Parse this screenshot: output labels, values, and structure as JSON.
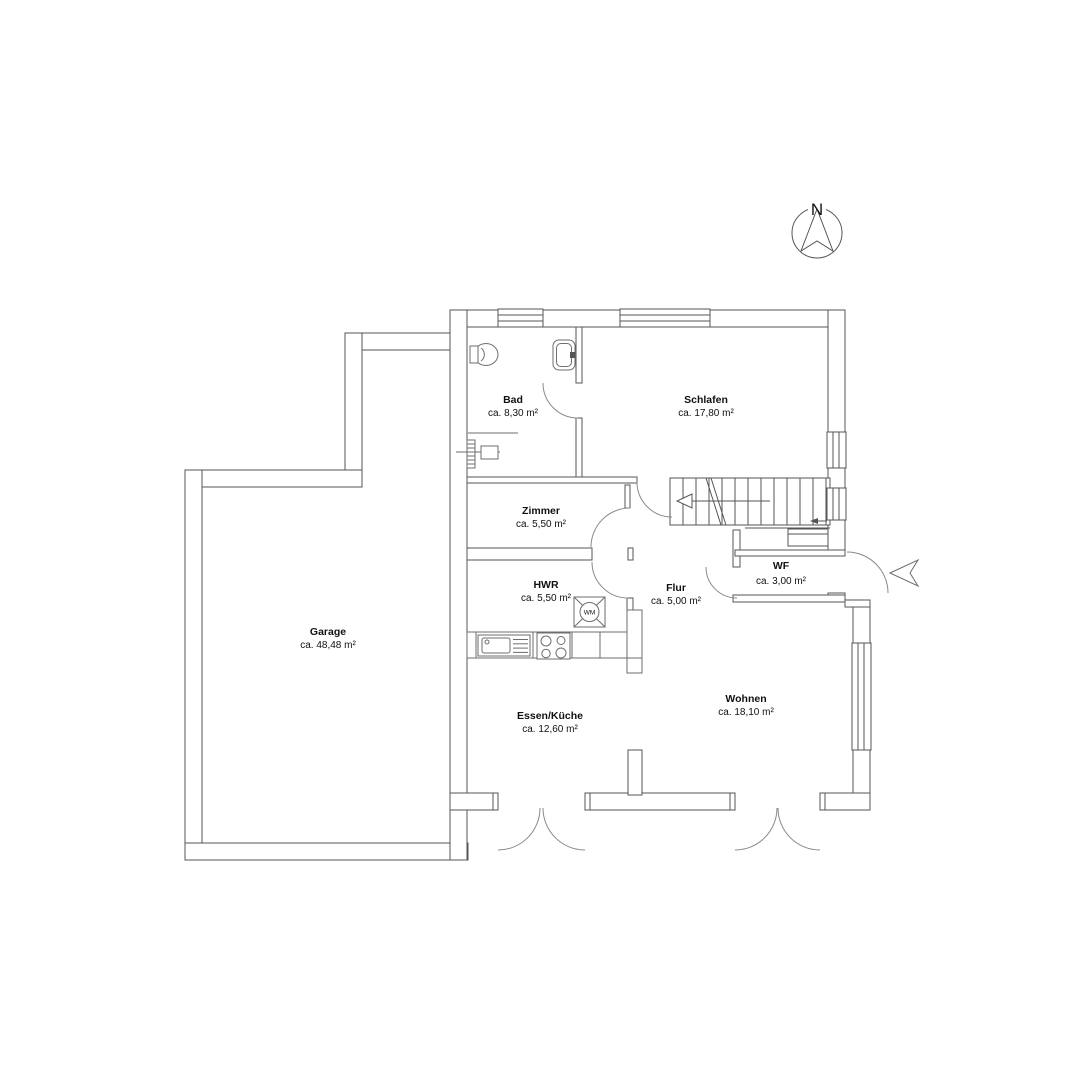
{
  "compass": {
    "label": "N"
  },
  "rooms": {
    "bad": {
      "name": "Bad",
      "area": "ca. 8,30 m²"
    },
    "schlafen": {
      "name": "Schlafen",
      "area": "ca. 17,80 m²"
    },
    "zimmer": {
      "name": "Zimmer",
      "area": "ca. 5,50 m²"
    },
    "hwr": {
      "name": "HWR",
      "area": "ca. 5,50 m²"
    },
    "flur": {
      "name": "Flur",
      "area": "ca. 5,00 m²"
    },
    "wf": {
      "name": "WF",
      "area": "ca. 3,00 m²"
    },
    "garage": {
      "name": "Garage",
      "area": "ca. 48,48 m²"
    },
    "essen_kueche": {
      "name": "Essen/Küche",
      "area": "ca. 12,60 m²"
    },
    "wohnen": {
      "name": "Wohnen",
      "area": "ca. 18,10 m²"
    }
  },
  "fixtures": {
    "washing_machine": "WM"
  },
  "colors": {
    "line": "#555555",
    "text": "#111111",
    "background": "#ffffff"
  }
}
